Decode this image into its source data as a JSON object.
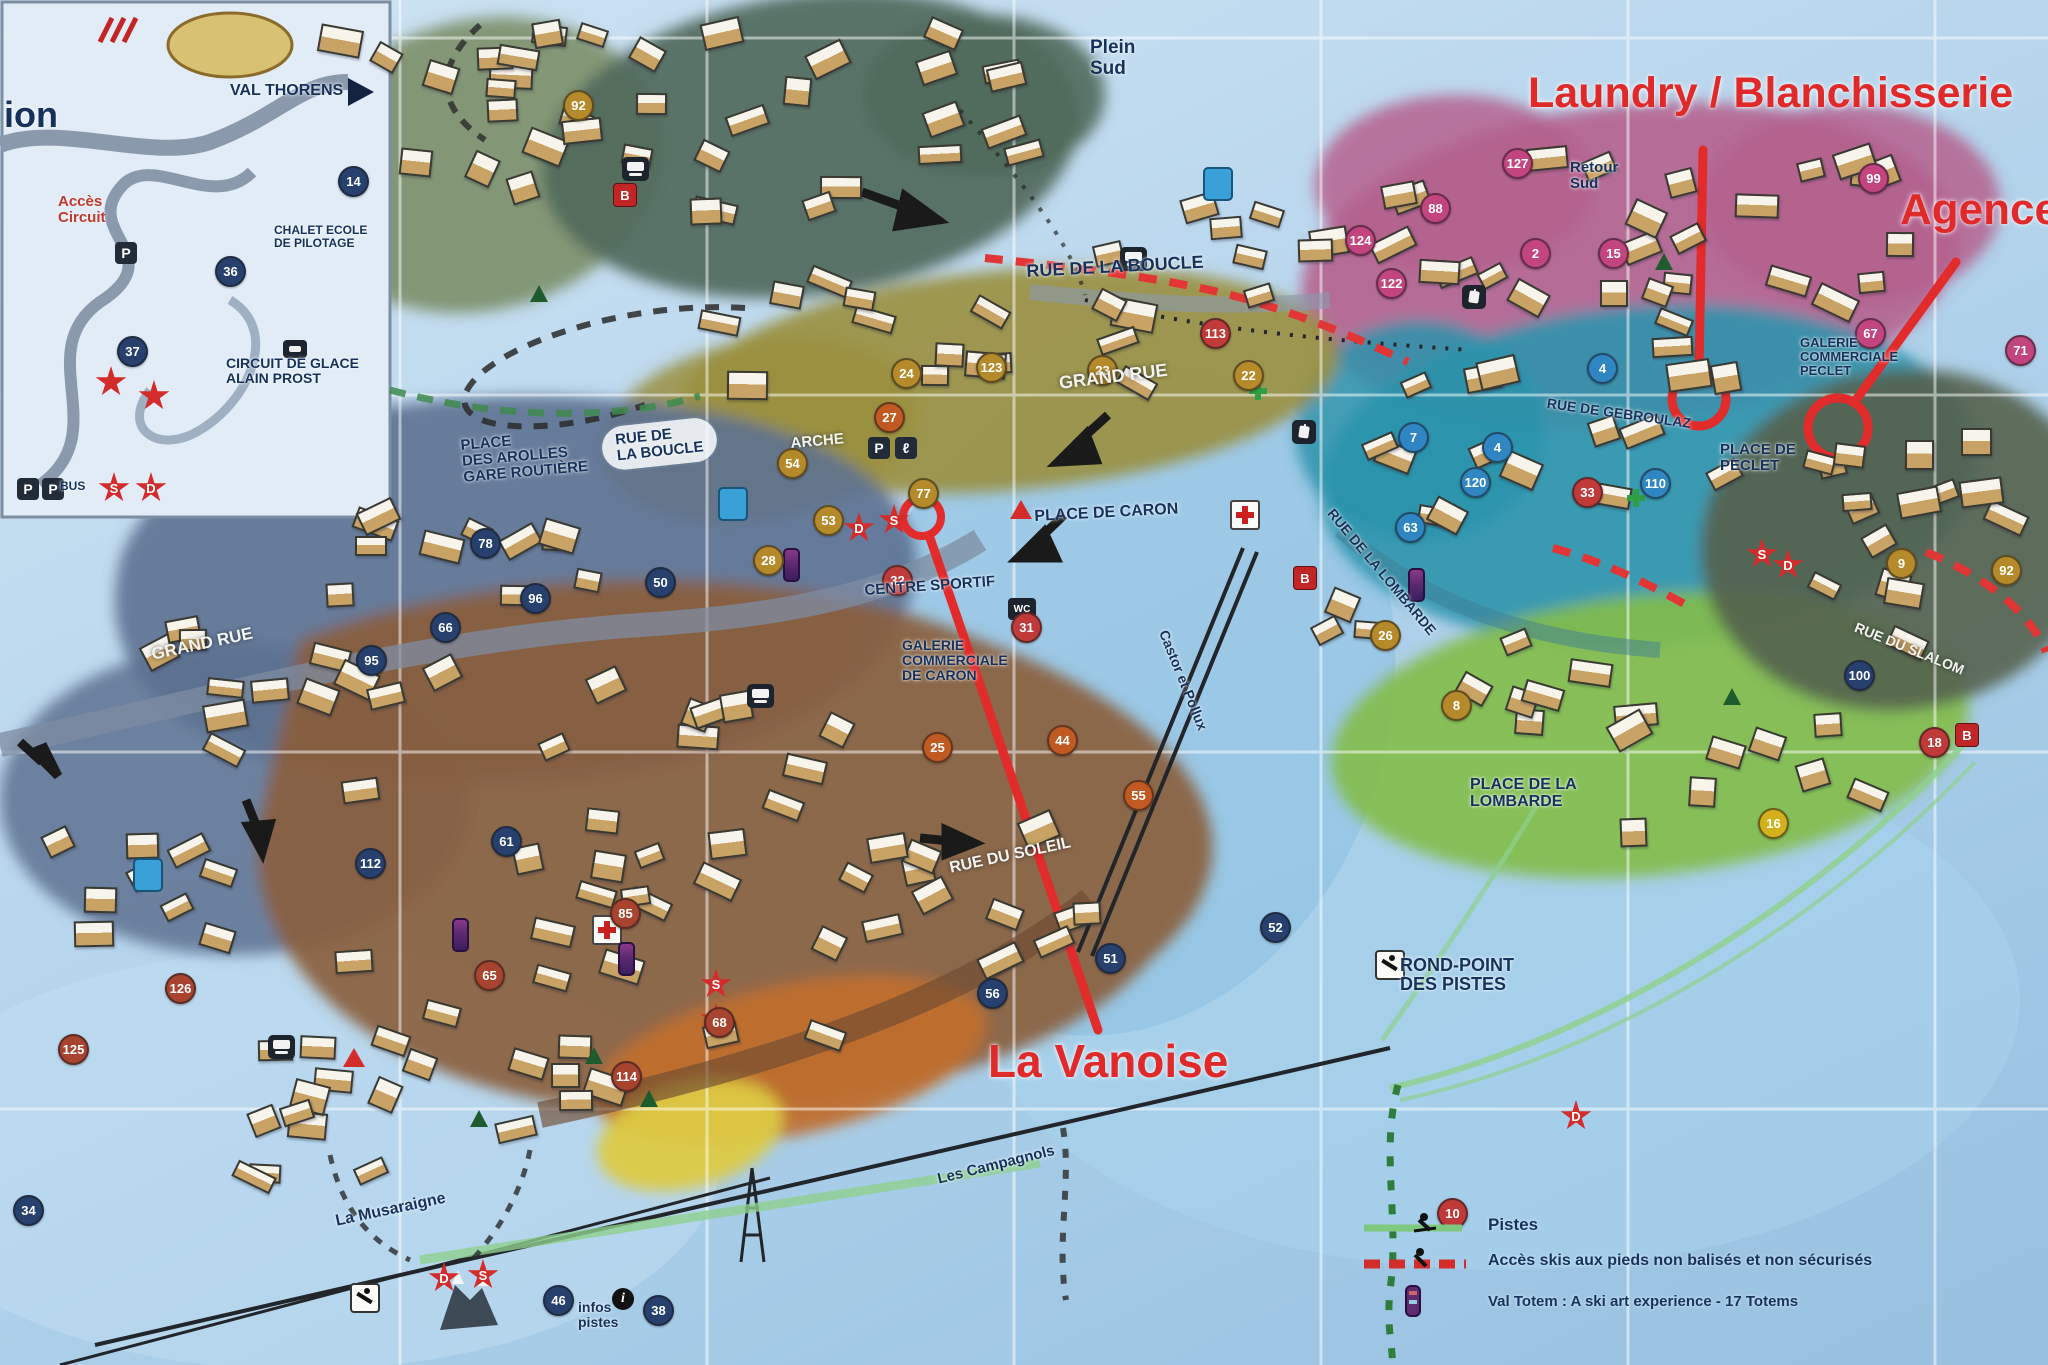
{
  "annotations": {
    "laundry": "Laundry / Blanchisserie",
    "agence": "Agence",
    "vanoise": "La Vanoise"
  },
  "legend": {
    "items": [
      {
        "label": "Pistes"
      },
      {
        "label": "Accès skis aux pieds non balisés et non sécurisés"
      },
      {
        "label": "Val Totem : A ski art experience - 17 Totems"
      }
    ]
  },
  "labels": [
    {
      "t": "ion",
      "x": 4,
      "y": 96,
      "s": 36
    },
    {
      "t": "VAL THORENS",
      "x": 230,
      "y": 82,
      "s": 16
    },
    {
      "t": "Accès\nCircuit",
      "x": 58,
      "y": 194,
      "s": 15,
      "c": "r"
    },
    {
      "t": "CHALET ECOLE\nDE PILOTAGE",
      "x": 274,
      "y": 224,
      "s": 12
    },
    {
      "t": "CIRCUIT DE GLACE\nALAIN PROST",
      "x": 226,
      "y": 356,
      "s": 14
    },
    {
      "t": "BUS",
      "x": 60,
      "y": 480,
      "s": 12
    },
    {
      "t": "Plein\nSud",
      "x": 1090,
      "y": 38,
      "s": 19
    },
    {
      "t": "Retour\nSud",
      "x": 1570,
      "y": 160,
      "s": 15
    },
    {
      "t": "RUE DE LA BOUCLE",
      "x": 1026,
      "y": 262,
      "s": 18,
      "r": -3
    },
    {
      "t": "GRAND RUE",
      "x": 1058,
      "y": 374,
      "s": 18,
      "r": -7,
      "c": "w"
    },
    {
      "t": "RUE DE GEBROULAZ",
      "x": 1548,
      "y": 396,
      "s": 14,
      "r": 8
    },
    {
      "t": "GALERIE\nCOMMERCIALE\nPECLET",
      "x": 1800,
      "y": 336,
      "s": 13
    },
    {
      "t": "PLACE DE\nPECLET",
      "x": 1720,
      "y": 442,
      "s": 15
    },
    {
      "t": "RUE DE LA LOMBARDE",
      "x": 1336,
      "y": 506,
      "s": 14,
      "r": 50
    },
    {
      "t": "RUE DU SLALOM",
      "x": 1858,
      "y": 620,
      "s": 14,
      "r": 22,
      "c": "w"
    },
    {
      "t": "PLACE DE LA\nLOMBARDE",
      "x": 1470,
      "y": 776,
      "s": 16
    },
    {
      "t": "ARCHE",
      "x": 790,
      "y": 436,
      "s": 15,
      "r": -5,
      "c": "w"
    },
    {
      "t": "RUE DE\nLA BOUCLE",
      "x": 600,
      "y": 428,
      "s": 15,
      "r": -6,
      "k": "oval"
    },
    {
      "t": "PLACE\nDES AROLLES\nGARE ROUTIÈRE",
      "x": 460,
      "y": 438,
      "s": 15,
      "r": -5
    },
    {
      "t": "PLACE DE CARON",
      "x": 1034,
      "y": 508,
      "s": 16,
      "r": -3
    },
    {
      "t": "CENTRE SPORTIF",
      "x": 864,
      "y": 583,
      "s": 15,
      "r": -4
    },
    {
      "t": "GALERIE\nCOMMERCIALE\nDE CARON",
      "x": 902,
      "y": 638,
      "s": 14
    },
    {
      "t": "GRAND RUE",
      "x": 150,
      "y": 646,
      "s": 17,
      "r": -12,
      "c": "w"
    },
    {
      "t": "Castor et Pollux",
      "x": 1170,
      "y": 628,
      "s": 14,
      "r": 68
    },
    {
      "t": "RUE DU SOLEIL",
      "x": 948,
      "y": 860,
      "s": 16,
      "r": -12,
      "c": "w"
    },
    {
      "t": "ROND-POINT\nDES PISTES",
      "x": 1400,
      "y": 956,
      "s": 18
    },
    {
      "t": "La Musaraigne",
      "x": 334,
      "y": 1213,
      "s": 16,
      "r": -12
    },
    {
      "t": "Les Campagnols",
      "x": 936,
      "y": 1172,
      "s": 15,
      "r": -14
    },
    {
      "t": "infos\npistes",
      "x": 578,
      "y": 1300,
      "s": 14
    }
  ],
  "markers": [
    {
      "n": "92",
      "x": 563,
      "y": 90,
      "c": "#b58a2a"
    },
    {
      "n": "127",
      "x": 1502,
      "y": 148,
      "c": "#c2457f"
    },
    {
      "n": "99",
      "x": 1858,
      "y": 163,
      "c": "#c2457f"
    },
    {
      "n": "88",
      "x": 1420,
      "y": 193,
      "c": "#c2457f"
    },
    {
      "n": "124",
      "x": 1345,
      "y": 225,
      "c": "#c2457f"
    },
    {
      "n": "122",
      "x": 1376,
      "y": 268,
      "c": "#c2457f"
    },
    {
      "n": "2",
      "x": 1520,
      "y": 238,
      "c": "#c2457f"
    },
    {
      "n": "15",
      "x": 1598,
      "y": 238,
      "c": "#c2457f"
    },
    {
      "n": "113",
      "x": 1200,
      "y": 318,
      "c": "#c03a3a"
    },
    {
      "n": "67",
      "x": 1855,
      "y": 318,
      "c": "#c2457f"
    },
    {
      "n": "71",
      "x": 2005,
      "y": 335,
      "c": "#c2457f"
    },
    {
      "n": "4",
      "x": 1587,
      "y": 353,
      "c": "#2f86c2"
    },
    {
      "n": "24",
      "x": 891,
      "y": 358,
      "c": "#b58a2a"
    },
    {
      "n": "23",
      "x": 1087,
      "y": 355,
      "c": "#b58a2a"
    },
    {
      "n": "22",
      "x": 1233,
      "y": 360,
      "c": "#b58a2a"
    },
    {
      "n": "123",
      "x": 976,
      "y": 352,
      "c": "#b58a2a"
    },
    {
      "n": "27",
      "x": 874,
      "y": 402,
      "c": "#c05a22"
    },
    {
      "n": "7",
      "x": 1398,
      "y": 422,
      "c": "#2f86c2"
    },
    {
      "n": "4",
      "x": 1482,
      "y": 432,
      "c": "#2f86c2"
    },
    {
      "n": "120",
      "x": 1460,
      "y": 467,
      "c": "#2f86c2"
    },
    {
      "n": "110",
      "x": 1640,
      "y": 468,
      "c": "#2f86c2"
    },
    {
      "n": "63",
      "x": 1395,
      "y": 512,
      "c": "#2f86c2"
    },
    {
      "n": "33",
      "x": 1572,
      "y": 477,
      "c": "#c03a3a"
    },
    {
      "n": "54",
      "x": 777,
      "y": 448,
      "c": "#b58a2a"
    },
    {
      "n": "77",
      "x": 908,
      "y": 478,
      "c": "#b58a2a"
    },
    {
      "n": "53",
      "x": 813,
      "y": 505,
      "c": "#b58a2a"
    },
    {
      "n": "28",
      "x": 753,
      "y": 545,
      "c": "#b58a2a"
    },
    {
      "n": "32",
      "x": 882,
      "y": 565,
      "c": "#c03a3a"
    },
    {
      "n": "31",
      "x": 1011,
      "y": 612,
      "c": "#c03a3a"
    },
    {
      "n": "78",
      "x": 470,
      "y": 528,
      "c": "#27406e"
    },
    {
      "n": "50",
      "x": 645,
      "y": 567,
      "c": "#27406e"
    },
    {
      "n": "96",
      "x": 520,
      "y": 583,
      "c": "#27406e"
    },
    {
      "n": "66",
      "x": 430,
      "y": 612,
      "c": "#27406e"
    },
    {
      "n": "95",
      "x": 356,
      "y": 645,
      "c": "#27406e"
    },
    {
      "n": "112",
      "x": 355,
      "y": 848,
      "c": "#27406e"
    },
    {
      "n": "61",
      "x": 491,
      "y": 826,
      "c": "#27406e"
    },
    {
      "n": "25",
      "x": 922,
      "y": 732,
      "c": "#c05a22"
    },
    {
      "n": "44",
      "x": 1047,
      "y": 725,
      "c": "#c05a22"
    },
    {
      "n": "55",
      "x": 1123,
      "y": 780,
      "c": "#c05a22"
    },
    {
      "n": "26",
      "x": 1370,
      "y": 620,
      "c": "#b58a2a"
    },
    {
      "n": "8",
      "x": 1441,
      "y": 690,
      "c": "#b58a2a"
    },
    {
      "n": "16",
      "x": 1758,
      "y": 808,
      "c": "#d4b11c"
    },
    {
      "n": "9",
      "x": 1886,
      "y": 548,
      "c": "#b58a2a"
    },
    {
      "n": "92",
      "x": 1991,
      "y": 555,
      "c": "#b58a2a"
    },
    {
      "n": "100",
      "x": 1844,
      "y": 660,
      "c": "#27406e"
    },
    {
      "n": "18",
      "x": 1919,
      "y": 727,
      "c": "#c03a3a"
    },
    {
      "n": "126",
      "x": 165,
      "y": 973,
      "c": "#a8432f"
    },
    {
      "n": "65",
      "x": 474,
      "y": 960,
      "c": "#a8432f"
    },
    {
      "n": "85",
      "x": 610,
      "y": 898,
      "c": "#a8432f"
    },
    {
      "n": "114",
      "x": 611,
      "y": 1061,
      "c": "#a8432f"
    },
    {
      "n": "68",
      "x": 704,
      "y": 1007,
      "c": "#a8432f"
    },
    {
      "n": "125",
      "x": 58,
      "y": 1034,
      "c": "#a8432f"
    },
    {
      "n": "34",
      "x": 13,
      "y": 1195,
      "c": "#27406e"
    },
    {
      "n": "52",
      "x": 1260,
      "y": 912,
      "c": "#27406e"
    },
    {
      "n": "51",
      "x": 1095,
      "y": 943,
      "c": "#27406e"
    },
    {
      "n": "56",
      "x": 977,
      "y": 978,
      "c": "#27406e"
    },
    {
      "n": "10",
      "x": 1437,
      "y": 1198,
      "c": "#c03a3a"
    },
    {
      "n": "38",
      "x": 643,
      "y": 1295,
      "c": "#27406e"
    },
    {
      "n": "46",
      "x": 543,
      "y": 1285,
      "c": "#27406e"
    },
    {
      "n": "14",
      "x": 338,
      "y": 166,
      "c": "#27406e"
    },
    {
      "n": "36",
      "x": 215,
      "y": 256,
      "c": "#27406e"
    },
    {
      "n": "37",
      "x": 117,
      "y": 336,
      "c": "#27406e"
    }
  ],
  "badges": [
    {
      "t": "S",
      "x": 98,
      "y": 472
    },
    {
      "t": "D",
      "x": 135,
      "y": 472
    },
    {
      "t": "",
      "x": 95,
      "y": 366
    },
    {
      "t": "",
      "x": 138,
      "y": 380
    },
    {
      "t": "D",
      "x": 843,
      "y": 512
    },
    {
      "t": "S",
      "x": 878,
      "y": 504
    },
    {
      "t": "S",
      "x": 1746,
      "y": 538
    },
    {
      "t": "D",
      "x": 1772,
      "y": 549
    },
    {
      "t": "S",
      "x": 700,
      "y": 968
    },
    {
      "t": "D",
      "x": 700,
      "y": 1003
    },
    {
      "t": "D",
      "x": 428,
      "y": 1262
    },
    {
      "t": "S",
      "x": 467,
      "y": 1259
    },
    {
      "t": "D",
      "x": 1560,
      "y": 1100
    }
  ],
  "bsquares": [
    {
      "t": "B",
      "x": 613,
      "y": 183
    },
    {
      "t": "B",
      "x": 1293,
      "y": 566
    },
    {
      "t": "B",
      "x": 1955,
      "y": 723
    }
  ],
  "icons": [
    {
      "k": "pblue",
      "x": 1203,
      "y": 167
    },
    {
      "k": "pblue",
      "x": 718,
      "y": 487
    },
    {
      "k": "pblue",
      "x": 133,
      "y": 858
    },
    {
      "k": "pdark",
      "t": "P",
      "x": 868,
      "y": 437
    },
    {
      "k": "pdark",
      "t": "P",
      "x": 115,
      "y": 242
    },
    {
      "k": "pdark",
      "t": "P",
      "x": 17,
      "y": 478
    },
    {
      "k": "pdark",
      "t": "P",
      "x": 42,
      "y": 478
    },
    {
      "k": "lift",
      "t": "ℓ",
      "x": 895,
      "y": 437
    },
    {
      "k": "bus",
      "x": 622,
      "y": 157
    },
    {
      "k": "bus",
      "x": 1120,
      "y": 247
    },
    {
      "k": "bus",
      "x": 268,
      "y": 1035
    },
    {
      "k": "bus",
      "x": 747,
      "y": 684
    },
    {
      "k": "gond",
      "x": 1462,
      "y": 285
    },
    {
      "k": "gond",
      "x": 1292,
      "y": 420
    },
    {
      "k": "wc",
      "t": "WC",
      "x": 1008,
      "y": 598
    },
    {
      "k": "cross",
      "x": 1230,
      "y": 500
    },
    {
      "k": "cross",
      "x": 592,
      "y": 915
    },
    {
      "k": "gcross",
      "x": 1625,
      "y": 487
    },
    {
      "k": "gcross",
      "x": 1247,
      "y": 380
    },
    {
      "k": "info",
      "t": "i",
      "x": 612,
      "y": 1288
    },
    {
      "k": "skier",
      "x": 350,
      "y": 1283
    },
    {
      "k": "skier",
      "x": 1375,
      "y": 950
    },
    {
      "k": "tri",
      "x": 343,
      "y": 1048
    },
    {
      "k": "tri",
      "x": 1010,
      "y": 500
    },
    {
      "k": "tree",
      "x": 530,
      "y": 285
    },
    {
      "k": "tree",
      "x": 1655,
      "y": 253
    },
    {
      "k": "tree",
      "x": 585,
      "y": 1047
    },
    {
      "k": "tree",
      "x": 640,
      "y": 1090
    },
    {
      "k": "tree",
      "x": 1723,
      "y": 688
    },
    {
      "k": "tree",
      "x": 470,
      "y": 1110
    },
    {
      "k": "totem",
      "x": 783,
      "y": 548
    },
    {
      "k": "totem",
      "x": 1408,
      "y": 568
    },
    {
      "k": "totem",
      "x": 618,
      "y": 942
    },
    {
      "k": "totem",
      "x": 452,
      "y": 918
    },
    {
      "k": "car",
      "x": 283,
      "y": 340
    }
  ]
}
